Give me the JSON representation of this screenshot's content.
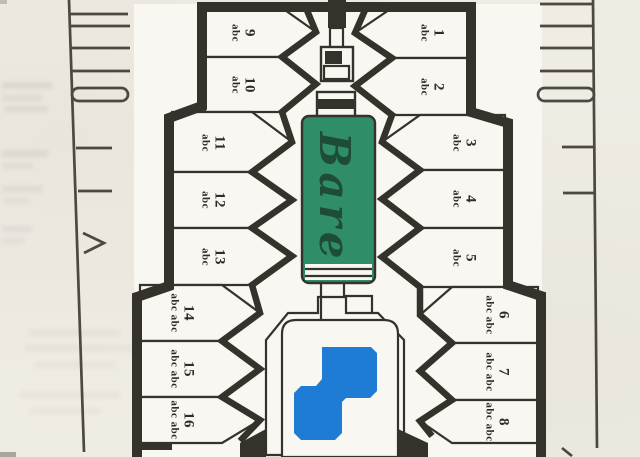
{
  "map": {
    "pond_label": "Bare",
    "lot_placeholder": "abc",
    "lots": [
      {
        "number": "1",
        "lines": [
          "1",
          "abc"
        ]
      },
      {
        "number": "2",
        "lines": [
          "2",
          "abc"
        ]
      },
      {
        "number": "3",
        "lines": [
          "3",
          "abc"
        ]
      },
      {
        "number": "4",
        "lines": [
          "4",
          "abc"
        ]
      },
      {
        "number": "5",
        "lines": [
          "5",
          "abc"
        ]
      },
      {
        "number": "6",
        "lines": [
          "6",
          "abc abc"
        ]
      },
      {
        "number": "7",
        "lines": [
          "7",
          "abc abc"
        ]
      },
      {
        "number": "8",
        "lines": [
          "8",
          "abc abc"
        ]
      },
      {
        "number": "9",
        "lines": [
          "9",
          "abc"
        ]
      },
      {
        "number": "10",
        "lines": [
          "10",
          "abc"
        ]
      },
      {
        "number": "11",
        "lines": [
          "11",
          "abc"
        ]
      },
      {
        "number": "12",
        "lines": [
          "12",
          "abc"
        ]
      },
      {
        "number": "13",
        "lines": [
          "13",
          "abc"
        ]
      },
      {
        "number": "14",
        "lines": [
          "14",
          "abc abc"
        ]
      },
      {
        "number": "15",
        "lines": [
          "15",
          "abc abc"
        ]
      },
      {
        "number": "16",
        "lines": [
          "16",
          "abc abc"
        ]
      }
    ],
    "colors": {
      "paper": "#efece4",
      "map_white": "#f8f7f2",
      "ink": "#34322a",
      "pond_green": "#2f8d68",
      "pool_blue": "#1f7cd4",
      "handwriting_ink": "#1d4736"
    }
  }
}
